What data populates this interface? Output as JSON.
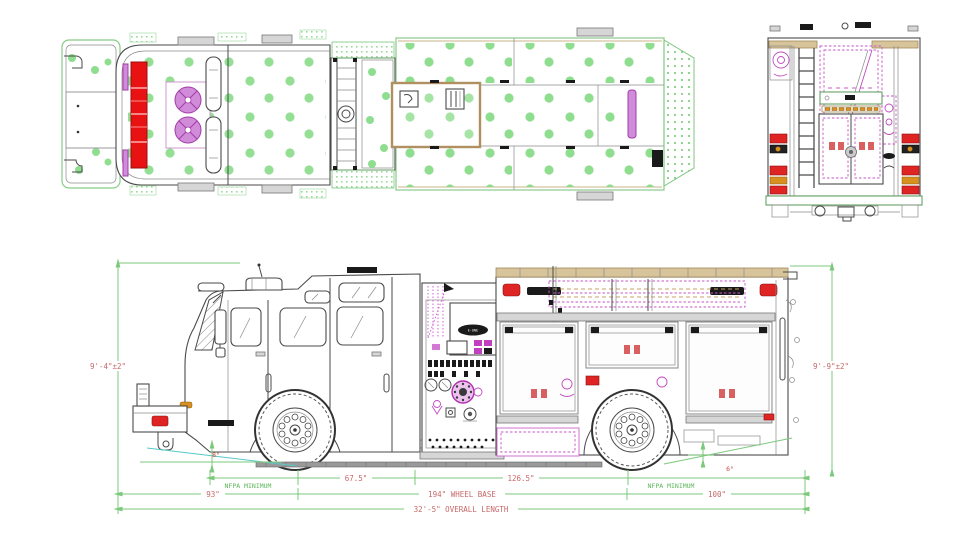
{
  "drawing": {
    "type": "fire-apparatus engineering drawing, three orthographic views (plan, rear elevation, side elevation)",
    "dimensions": {
      "height_front": "9'-4\"±2\"",
      "height_rear": "9'-9\"±2\"",
      "approach_angle": "8°",
      "departure_angle": "6°",
      "nfpa_front": "NFPA MINIMUM",
      "nfpa_rear": "NFPA MINIMUM",
      "front_axle_to_pump": "67.5\"",
      "pump_to_rear_axle": "126.5\"",
      "front_overhang": "93\"",
      "wheelbase": "194\" WHEEL BASE",
      "rear_overhang": "100\"",
      "overall_length": "32'-5\" OVERALL LENGTH"
    },
    "branding": {
      "pump_panel_logo": "E-ONE"
    },
    "colors": {
      "dimension_line_green": "#7cc87c",
      "dimension_text_red": "#c86868",
      "annotation_green": "#5cb85c",
      "treadplate_dot_green": "#8fdd8f",
      "detail_magenta": "#cc44cc",
      "lightbar_red": "#e01010",
      "warning_light_red": "#df2424",
      "marker_amber": "#d89020",
      "handrail_tan": "#d8c49a",
      "approach_line_cyan": "#58c8c8"
    }
  }
}
